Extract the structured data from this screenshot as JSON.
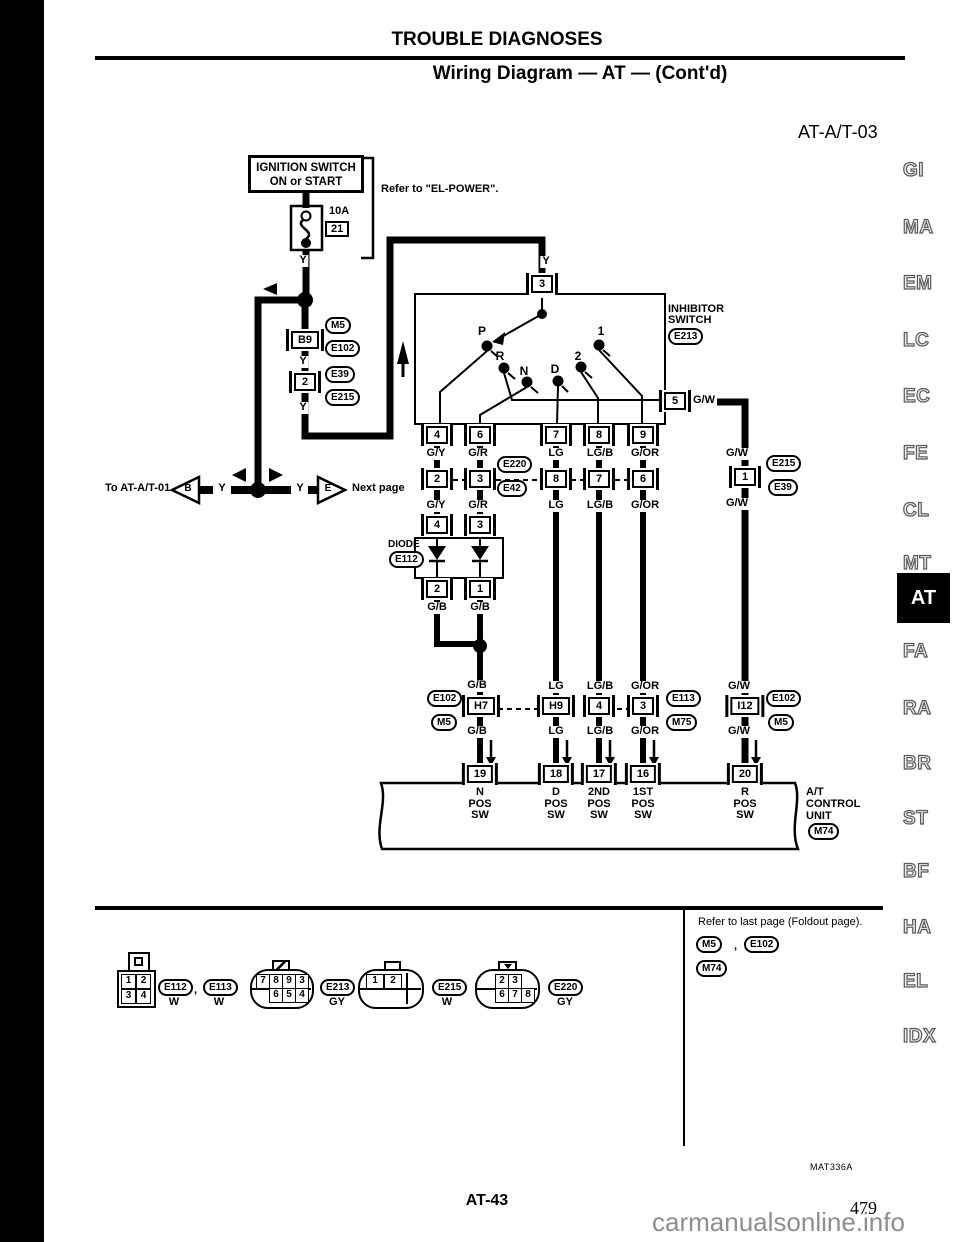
{
  "header": {
    "title": "TROUBLE DIAGNOSES",
    "subtitle": "Wiring Diagram — AT — (Cont'd)",
    "diagram_id": "AT-A/T-03"
  },
  "margin_tabs": [
    "GI",
    "MA",
    "EM",
    "LC",
    "EC",
    "FE",
    "CL",
    "MT",
    "AT",
    "FA",
    "RA",
    "BR",
    "ST",
    "BF",
    "HA",
    "EL",
    "IDX"
  ],
  "power": {
    "source_line1": "IGNITION SWITCH",
    "source_line2": "ON or START",
    "fuse_amp": "10A",
    "fuse_no": "21",
    "refer_note": "Refer to \"EL-POWER\"."
  },
  "wire": {
    "y": "Y",
    "gy": "G/Y",
    "gr": "G/R",
    "lg": "LG",
    "lgb": "LG/B",
    "gor": "G/OR",
    "gw": "G/W",
    "gb": "G/B"
  },
  "refs": {
    "m5": "M5",
    "e102": "E102",
    "e39": "E39",
    "e215": "E215",
    "e213": "E213",
    "e220": "E220",
    "e42": "E42",
    "e112": "E112",
    "e113": "E113",
    "m75": "M75",
    "m74": "M74"
  },
  "connectors": {
    "b9": "B9",
    "c2": "2",
    "c1": "1"
  },
  "inhibitor": {
    "name1": "INHIBITOR",
    "name2": "SWITCH",
    "top_terminal": "3",
    "right_terminal": "5",
    "positions": [
      "P",
      "R",
      "N",
      "D",
      "2",
      "1"
    ],
    "terminals": [
      "4",
      "6",
      "7",
      "8",
      "9"
    ]
  },
  "mid_row": [
    "2",
    "3",
    "8",
    "7",
    "6"
  ],
  "links": {
    "prev_text": "To AT-A/T-01",
    "prev_id": "B",
    "next_id": "E",
    "next_text": "Next page"
  },
  "diode": {
    "label": "DIODE",
    "top": [
      "4",
      "3"
    ],
    "bottom": [
      "2",
      "1"
    ]
  },
  "h_row": [
    "H7",
    "H9",
    "4",
    "3",
    "I12"
  ],
  "cu_terminals": [
    "19",
    "18",
    "17",
    "16",
    "20"
  ],
  "control_unit": {
    "switches": [
      [
        "N",
        "POS",
        "SW"
      ],
      [
        "D",
        "POS",
        "SW"
      ],
      [
        "2ND",
        "POS",
        "SW"
      ],
      [
        "1ST",
        "POS",
        "SW"
      ],
      [
        "R",
        "POS",
        "SW"
      ]
    ],
    "name": [
      "A/T",
      "CONTROL",
      "UNIT"
    ]
  },
  "footnote": {
    "text": "Refer to last page (Foldout page)."
  },
  "misc": {
    "comma": ","
  },
  "gallery": {
    "g1": {
      "pins": [
        "1",
        "2",
        "3",
        "4"
      ],
      "id1": "E112",
      "color1": "W",
      "id2": "E113",
      "color2": "W"
    },
    "g2": {
      "top": [
        "7",
        "8",
        "9",
        "3"
      ],
      "bottom": [
        "6",
        "5",
        "4"
      ],
      "id": "E213",
      "color": "GY"
    },
    "g3": {
      "top": [
        "1",
        "2"
      ],
      "id": "E215",
      "color": "W"
    },
    "g4": {
      "top": [
        "2",
        "3"
      ],
      "bottom": [
        "6",
        "7",
        "8"
      ],
      "id": "E220",
      "color": "GY"
    }
  },
  "footer": {
    "code": "MAT336A",
    "page_label": "AT-43",
    "page_number": "479",
    "watermark": "carmanualsonline.info"
  }
}
